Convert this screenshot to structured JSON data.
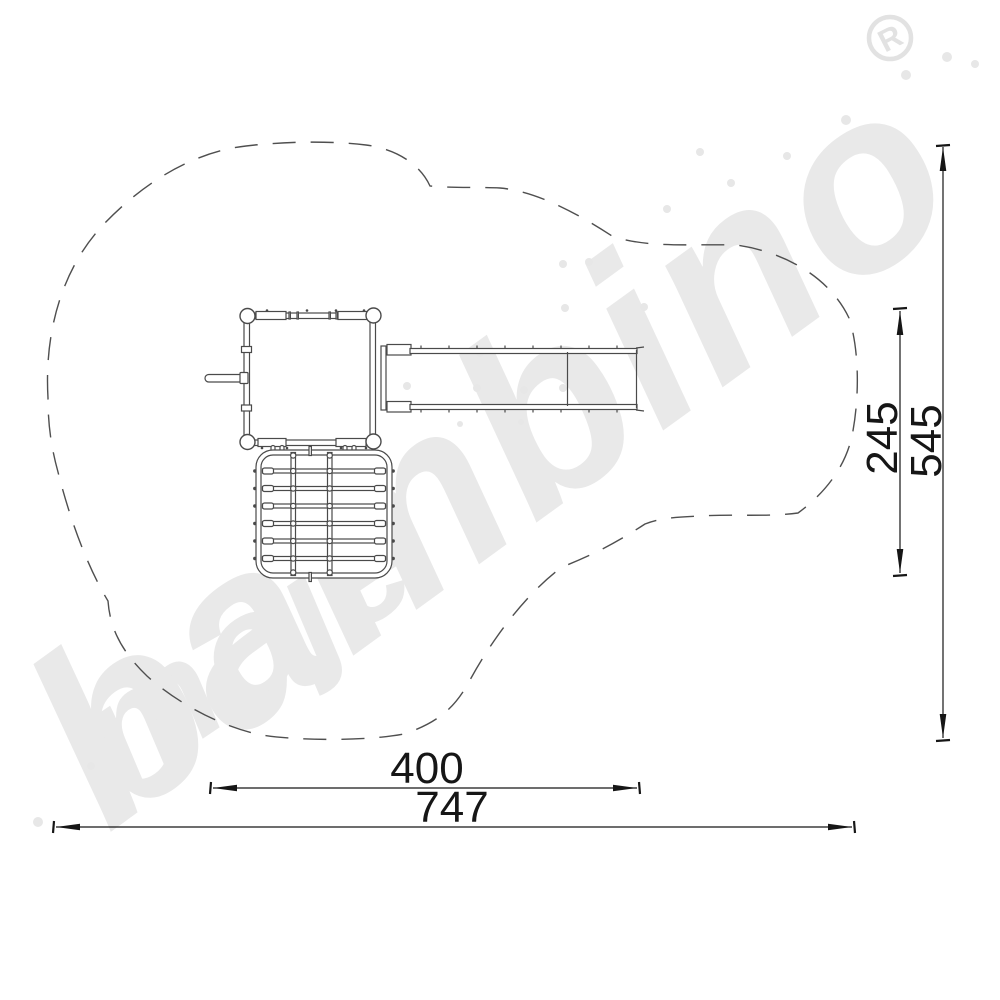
{
  "watermark": {
    "script_word_small": "moje",
    "script_word_large": "bambino",
    "registered_letter": "R",
    "color": "#e9e9e9"
  },
  "dimensions": {
    "horizontal_inner": "400",
    "horizontal_total": "747",
    "vertical_inner": "245",
    "vertical_total": "545"
  },
  "colors": {
    "structure_line": "#4a4a4a",
    "safety_zone_line": "#4f4f4f",
    "dimension_line": "#161616",
    "watermark_gray": "#e9e9e9",
    "background": "#ffffff"
  }
}
